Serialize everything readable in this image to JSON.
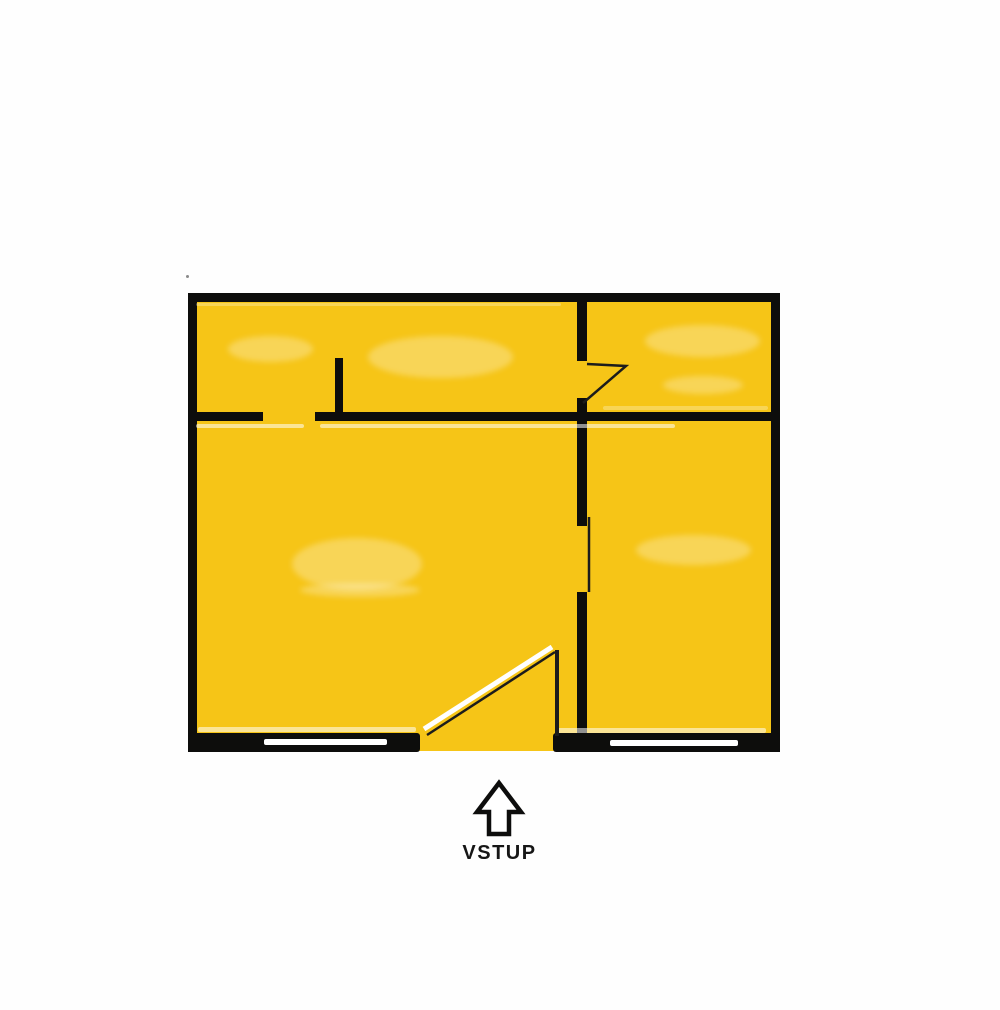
{
  "entrance": {
    "label": "VSTUP"
  },
  "icons": {
    "arrow": "up-arrow-icon"
  },
  "colors": {
    "background": "#FEFEFE",
    "floor_fill": "#F6C517",
    "wall": "#0D0D0C",
    "door_line": "#1C1C1C",
    "window_slot": "#FFFFFF",
    "label_text": "#161616"
  }
}
